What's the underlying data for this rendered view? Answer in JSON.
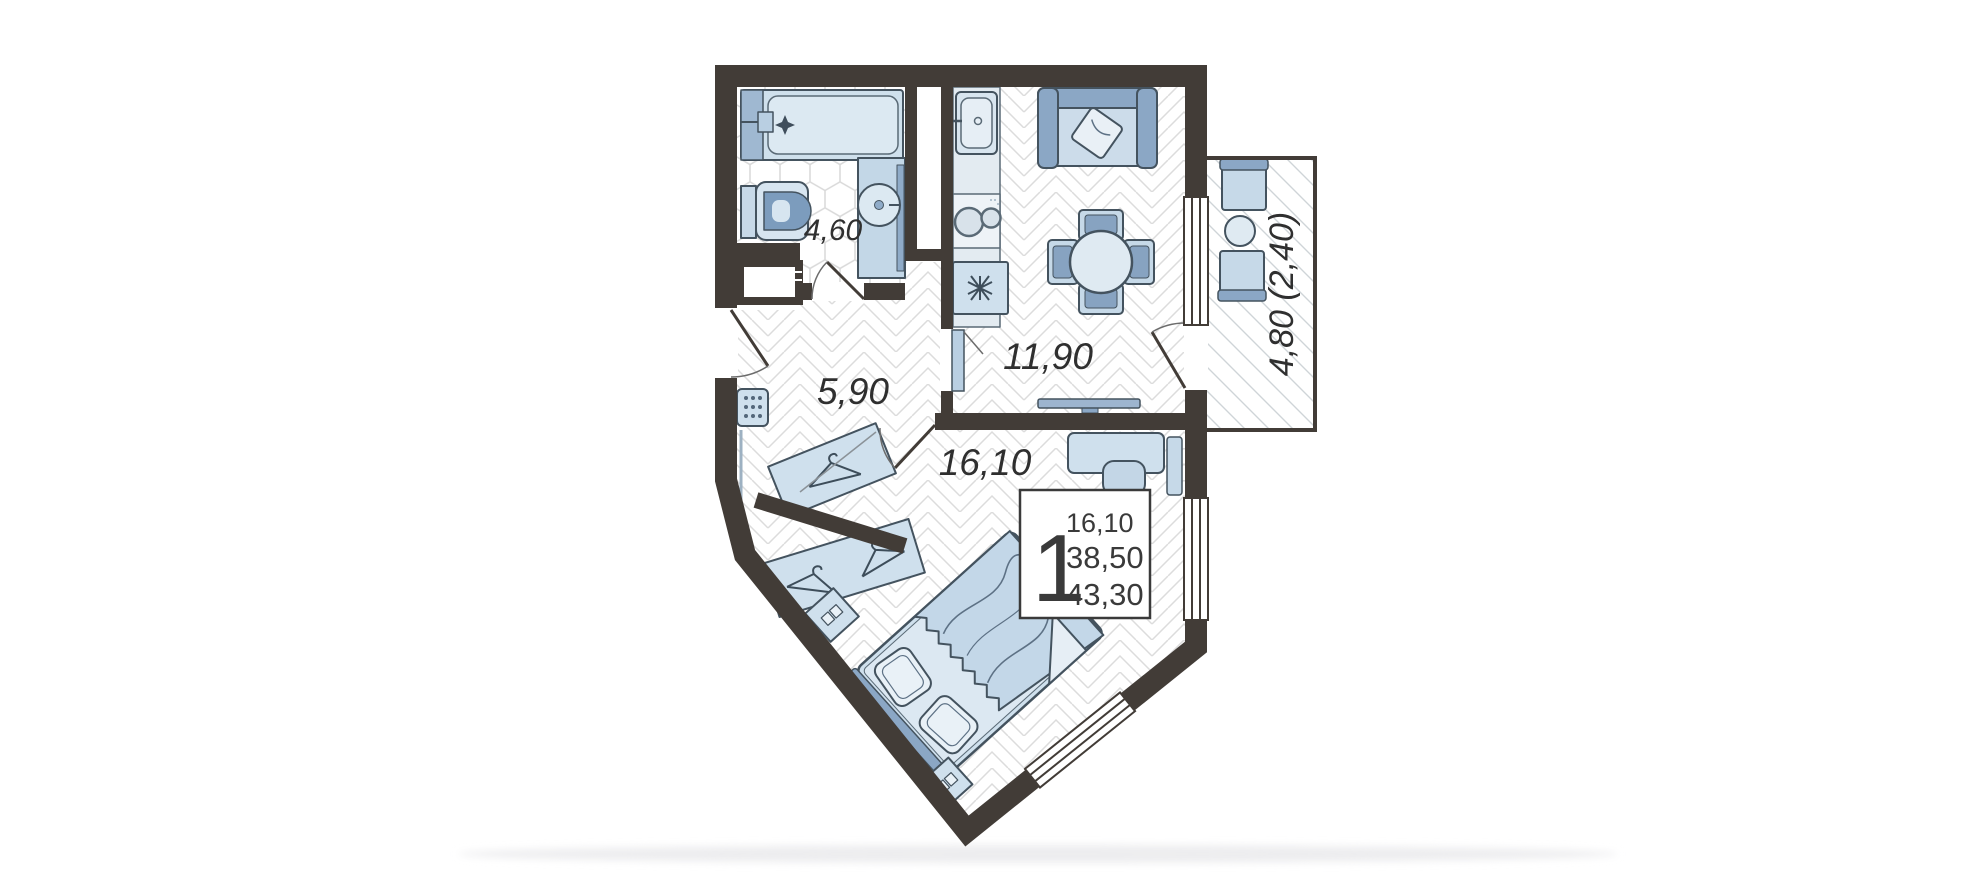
{
  "page": {
    "background": "#ffffff",
    "shadow_color": "#eeeef0"
  },
  "floor_plan": {
    "colors": {
      "wall": "#423c37",
      "furniture_light": "#cfe0ed",
      "furniture_medium": "#8ba7c5",
      "outline": "#44535f",
      "floor_lines": "#dadada",
      "label_text": "#2f2f2f"
    },
    "rooms": [
      {
        "id": "bathroom",
        "area_label": "4,60"
      },
      {
        "id": "hallway",
        "area_label": "5,90"
      },
      {
        "id": "kitchen-living",
        "area_label": "11,90"
      },
      {
        "id": "bedroom",
        "area_label": "16,10"
      },
      {
        "id": "balcony",
        "area_label": "4,80 (2,40)"
      }
    ],
    "info_box": {
      "rooms_count": "1",
      "living_area": "16,10",
      "total_area": "38,50",
      "total_area_with_balcony": "43,30"
    }
  }
}
